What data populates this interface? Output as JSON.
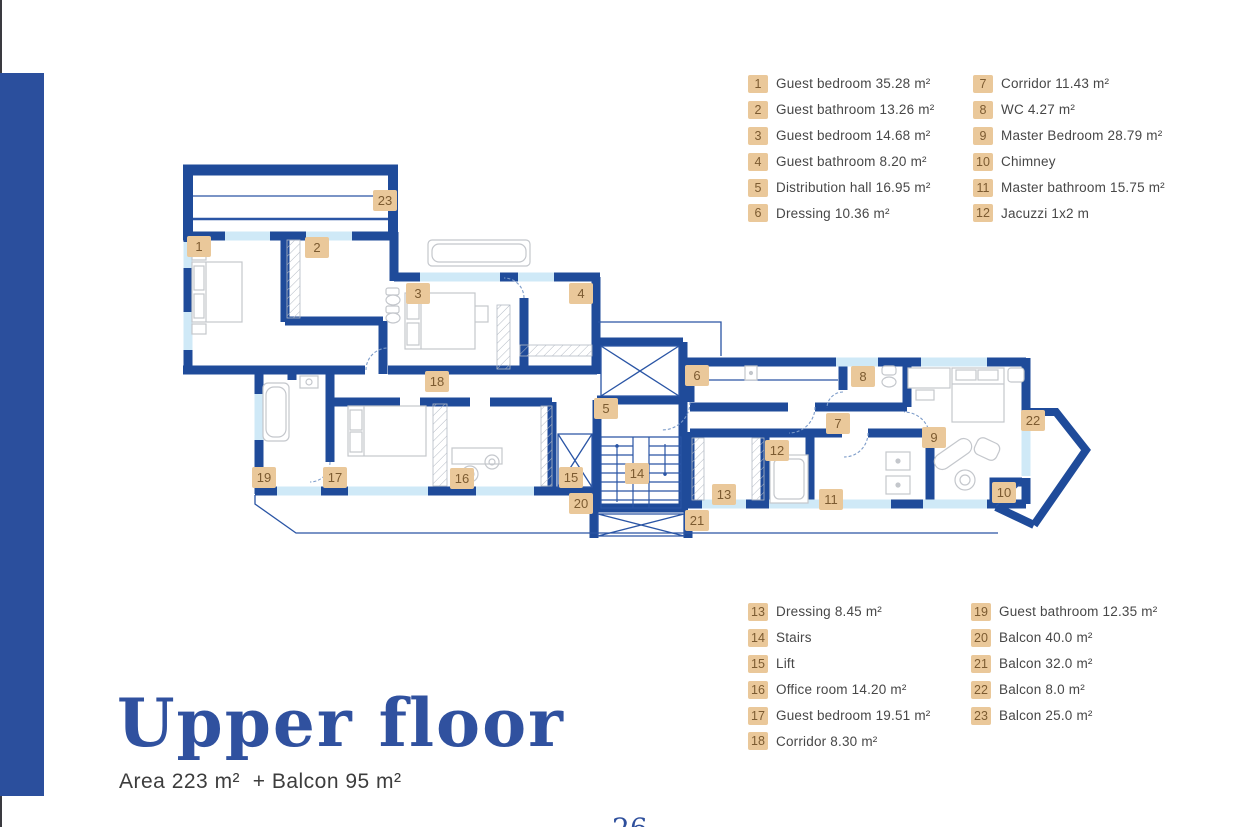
{
  "brand": {
    "wall_color": "#1f4b9a",
    "window_color": "#cfe9f7",
    "thin_line_color": "#2a55a5",
    "badge_bg": "#eac89a",
    "badge_text": "#7c5b31",
    "accent_blue": "#30519f",
    "side_bar_color": "#2b4f9d"
  },
  "title": {
    "heading": "Upper floor",
    "subheading": "Area 223 m²  + Balcon 95 m²"
  },
  "page": {
    "number": "26"
  },
  "legend_top": {
    "columns": [
      [
        {
          "n": "1",
          "label": "Guest bedroom 35.28 m²"
        },
        {
          "n": "2",
          "label": "Guest bathroom 13.26 m²"
        },
        {
          "n": "3",
          "label": "Guest bedroom 14.68 m²"
        },
        {
          "n": "4",
          "label": "Guest bathroom 8.20 m²"
        },
        {
          "n": "5",
          "label": "Distribution hall 16.95 m²"
        },
        {
          "n": "6",
          "label": "Dressing 10.36 m²"
        }
      ],
      [
        {
          "n": "7",
          "label": "Corridor 11.43 m²"
        },
        {
          "n": "8",
          "label": "WC 4.27 m²"
        },
        {
          "n": "9",
          "label": "Master Bedroom 28.79 m²"
        },
        {
          "n": "10",
          "label": "Chimney"
        },
        {
          "n": "11",
          "label": "Master bathroom 15.75 m²"
        },
        {
          "n": "12",
          "label": "Jacuzzi 1x2 m"
        }
      ]
    ]
  },
  "legend_bottom": {
    "columns": [
      [
        {
          "n": "13",
          "label": "Dressing 8.45 m²"
        },
        {
          "n": "14",
          "label": "Stairs"
        },
        {
          "n": "15",
          "label": "Lift"
        },
        {
          "n": "16",
          "label": "Office room 14.20 m²"
        },
        {
          "n": "17",
          "label": "Guest bedroom 19.51 m²"
        },
        {
          "n": "18",
          "label": "Corridor 8.30 m²"
        }
      ],
      [
        {
          "n": "19",
          "label": "Guest bathroom 12.35 m²"
        },
        {
          "n": "20",
          "label": "Balcon 40.0 m²"
        },
        {
          "n": "21",
          "label": "Balcon 32.0 m²"
        },
        {
          "n": "22",
          "label": "Balcon 8.0 m²"
        },
        {
          "n": "23",
          "label": "Balcon 25.0 m²"
        }
      ]
    ]
  },
  "plan": {
    "badges": [
      {
        "n": "1",
        "x": 199,
        "y": 246
      },
      {
        "n": "2",
        "x": 317,
        "y": 247
      },
      {
        "n": "3",
        "x": 418,
        "y": 293
      },
      {
        "n": "4",
        "x": 581,
        "y": 293
      },
      {
        "n": "5",
        "x": 606,
        "y": 408
      },
      {
        "n": "6",
        "x": 697,
        "y": 375
      },
      {
        "n": "7",
        "x": 838,
        "y": 423
      },
      {
        "n": "8",
        "x": 863,
        "y": 376
      },
      {
        "n": "9",
        "x": 934,
        "y": 437
      },
      {
        "n": "10",
        "x": 1004,
        "y": 492
      },
      {
        "n": "11",
        "x": 831,
        "y": 499
      },
      {
        "n": "12",
        "x": 777,
        "y": 450
      },
      {
        "n": "13",
        "x": 724,
        "y": 494
      },
      {
        "n": "14",
        "x": 637,
        "y": 473
      },
      {
        "n": "15",
        "x": 571,
        "y": 477
      },
      {
        "n": "16",
        "x": 462,
        "y": 478
      },
      {
        "n": "17",
        "x": 335,
        "y": 477
      },
      {
        "n": "18",
        "x": 437,
        "y": 381
      },
      {
        "n": "19",
        "x": 264,
        "y": 477
      },
      {
        "n": "20",
        "x": 581,
        "y": 503
      },
      {
        "n": "21",
        "x": 697,
        "y": 520
      },
      {
        "n": "22",
        "x": 1033,
        "y": 420
      },
      {
        "n": "23",
        "x": 385,
        "y": 200
      }
    ]
  }
}
